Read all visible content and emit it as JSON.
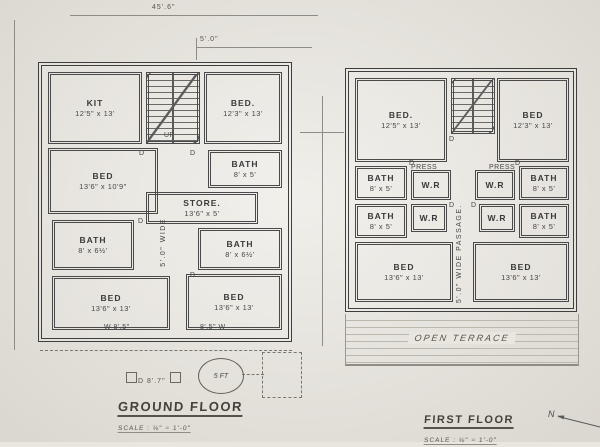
{
  "colors": {
    "paper": "#e9e6df",
    "ink": "#3e3e3e",
    "faint": "#8f8c85"
  },
  "dimensions": {
    "overall_width": "45'.6\"",
    "top_offset": "5'.0\""
  },
  "titles": {
    "ground": {
      "label": "GROUND FLOOR",
      "scale": "SCALE : ⅛\" = 1'-0\""
    },
    "first": {
      "label": "FIRST FLOOR",
      "scale": "SCALE : ⅛\" = 1'-0\""
    }
  },
  "north": {
    "label": "N"
  },
  "terrace": {
    "label": "OPEN TERRACE"
  },
  "porch": {
    "circle_label": "5 FT",
    "door_label": "D 8'.7\""
  },
  "plans": [
    {
      "name": "ground-floor",
      "rooms": [
        {
          "key": "kitchen",
          "label": "KIT",
          "dims": "12'5\" x 13'",
          "x": 6,
          "y": 6,
          "w": 94,
          "h": 72
        },
        {
          "key": "staircase",
          "label": "",
          "dims": "",
          "x": 104,
          "y": 6,
          "w": 54,
          "h": 72,
          "type": "stair"
        },
        {
          "key": "bed-top-right",
          "label": "BED.",
          "dims": "12'3\" x 13'",
          "x": 162,
          "y": 6,
          "w": 78,
          "h": 72
        },
        {
          "key": "bed-mid-left",
          "label": "BED",
          "dims": "13'6\" x 10'9\"",
          "x": 6,
          "y": 82,
          "w": 110,
          "h": 66
        },
        {
          "key": "bath-top-right",
          "label": "BATH",
          "dims": "8' x 5'",
          "x": 166,
          "y": 84,
          "w": 74,
          "h": 38
        },
        {
          "key": "store",
          "label": "STORE.",
          "dims": "13'6\" x 5'",
          "x": 104,
          "y": 126,
          "w": 112,
          "h": 32
        },
        {
          "key": "bath-mid-left",
          "label": "BATH",
          "dims": "8' x 6½'",
          "x": 10,
          "y": 154,
          "w": 82,
          "h": 50
        },
        {
          "key": "bath-mid-right",
          "label": "BATH",
          "dims": "8' x 6½'",
          "x": 156,
          "y": 162,
          "w": 84,
          "h": 42
        },
        {
          "key": "bed-bottom-left",
          "label": "BED",
          "dims": "13'6\" x 13'",
          "x": 10,
          "y": 210,
          "w": 118,
          "h": 54
        },
        {
          "key": "bed-bottom-right",
          "label": "BED",
          "dims": "13'6\" x 13'",
          "x": 144,
          "y": 208,
          "w": 96,
          "h": 56
        }
      ],
      "annotations": [
        {
          "text": "5'.0\" WIDE",
          "x": 118,
          "y": 152,
          "vertical": true
        },
        {
          "text": "UP",
          "x": 122,
          "y": 66
        },
        {
          "text": "D",
          "x": 97,
          "y": 84
        },
        {
          "text": "D",
          "x": 148,
          "y": 84
        },
        {
          "text": "D",
          "x": 96,
          "y": 152
        },
        {
          "text": "D",
          "x": 148,
          "y": 206
        },
        {
          "text": "W 8'.5\"",
          "x": 62,
          "y": 258
        },
        {
          "text": "8'.5\" W",
          "x": 158,
          "y": 258
        }
      ]
    },
    {
      "name": "first-floor",
      "rooms": [
        {
          "key": "bed-top-left",
          "label": "BED.",
          "dims": "12'5\" x 13'",
          "x": 6,
          "y": 6,
          "w": 92,
          "h": 84
        },
        {
          "key": "staircase",
          "label": "",
          "dims": "",
          "x": 102,
          "y": 6,
          "w": 44,
          "h": 56,
          "type": "stair"
        },
        {
          "key": "bed-top-right",
          "label": "BED",
          "dims": "12'3\" x 13'",
          "x": 148,
          "y": 6,
          "w": 72,
          "h": 84
        },
        {
          "key": "bath-left-1",
          "label": "BATH",
          "dims": "8' x 5'",
          "x": 6,
          "y": 94,
          "w": 52,
          "h": 34
        },
        {
          "key": "wr-left-1",
          "label": "W.R",
          "dims": "",
          "x": 62,
          "y": 98,
          "w": 40,
          "h": 30
        },
        {
          "key": "wr-right-1",
          "label": "W.R",
          "dims": "",
          "x": 126,
          "y": 98,
          "w": 40,
          "h": 30
        },
        {
          "key": "bath-right-1",
          "label": "BATH",
          "dims": "8' x 5'",
          "x": 170,
          "y": 94,
          "w": 50,
          "h": 34
        },
        {
          "key": "bath-left-2",
          "label": "BATH",
          "dims": "8' x 5'",
          "x": 6,
          "y": 132,
          "w": 52,
          "h": 34
        },
        {
          "key": "wr-left-2",
          "label": "W.R",
          "dims": "",
          "x": 62,
          "y": 132,
          "w": 36,
          "h": 28
        },
        {
          "key": "wr-right-2",
          "label": "W.R",
          "dims": "",
          "x": 130,
          "y": 132,
          "w": 36,
          "h": 28
        },
        {
          "key": "bath-right-2",
          "label": "BATH",
          "dims": "8' x 5'",
          "x": 170,
          "y": 132,
          "w": 50,
          "h": 34
        },
        {
          "key": "bed-bottom-left",
          "label": "BED",
          "dims": "13'6\" x 13'",
          "x": 6,
          "y": 170,
          "w": 98,
          "h": 60
        },
        {
          "key": "bed-bottom-right",
          "label": "BED",
          "dims": "13'6\" x 13'",
          "x": 124,
          "y": 170,
          "w": 96,
          "h": 60
        }
      ],
      "annotations": [
        {
          "text": "5'.0\" WIDE PASSAGE.",
          "x": 107,
          "y": 132,
          "vertical": true
        },
        {
          "text": "PRESS",
          "x": 62,
          "y": 92
        },
        {
          "text": "PRESS",
          "x": 140,
          "y": 92
        },
        {
          "text": "D",
          "x": 100,
          "y": 64
        },
        {
          "text": "D",
          "x": 60,
          "y": 88
        },
        {
          "text": "D",
          "x": 166,
          "y": 88
        },
        {
          "text": "D",
          "x": 100,
          "y": 130
        },
        {
          "text": "D",
          "x": 122,
          "y": 130
        }
      ]
    }
  ]
}
